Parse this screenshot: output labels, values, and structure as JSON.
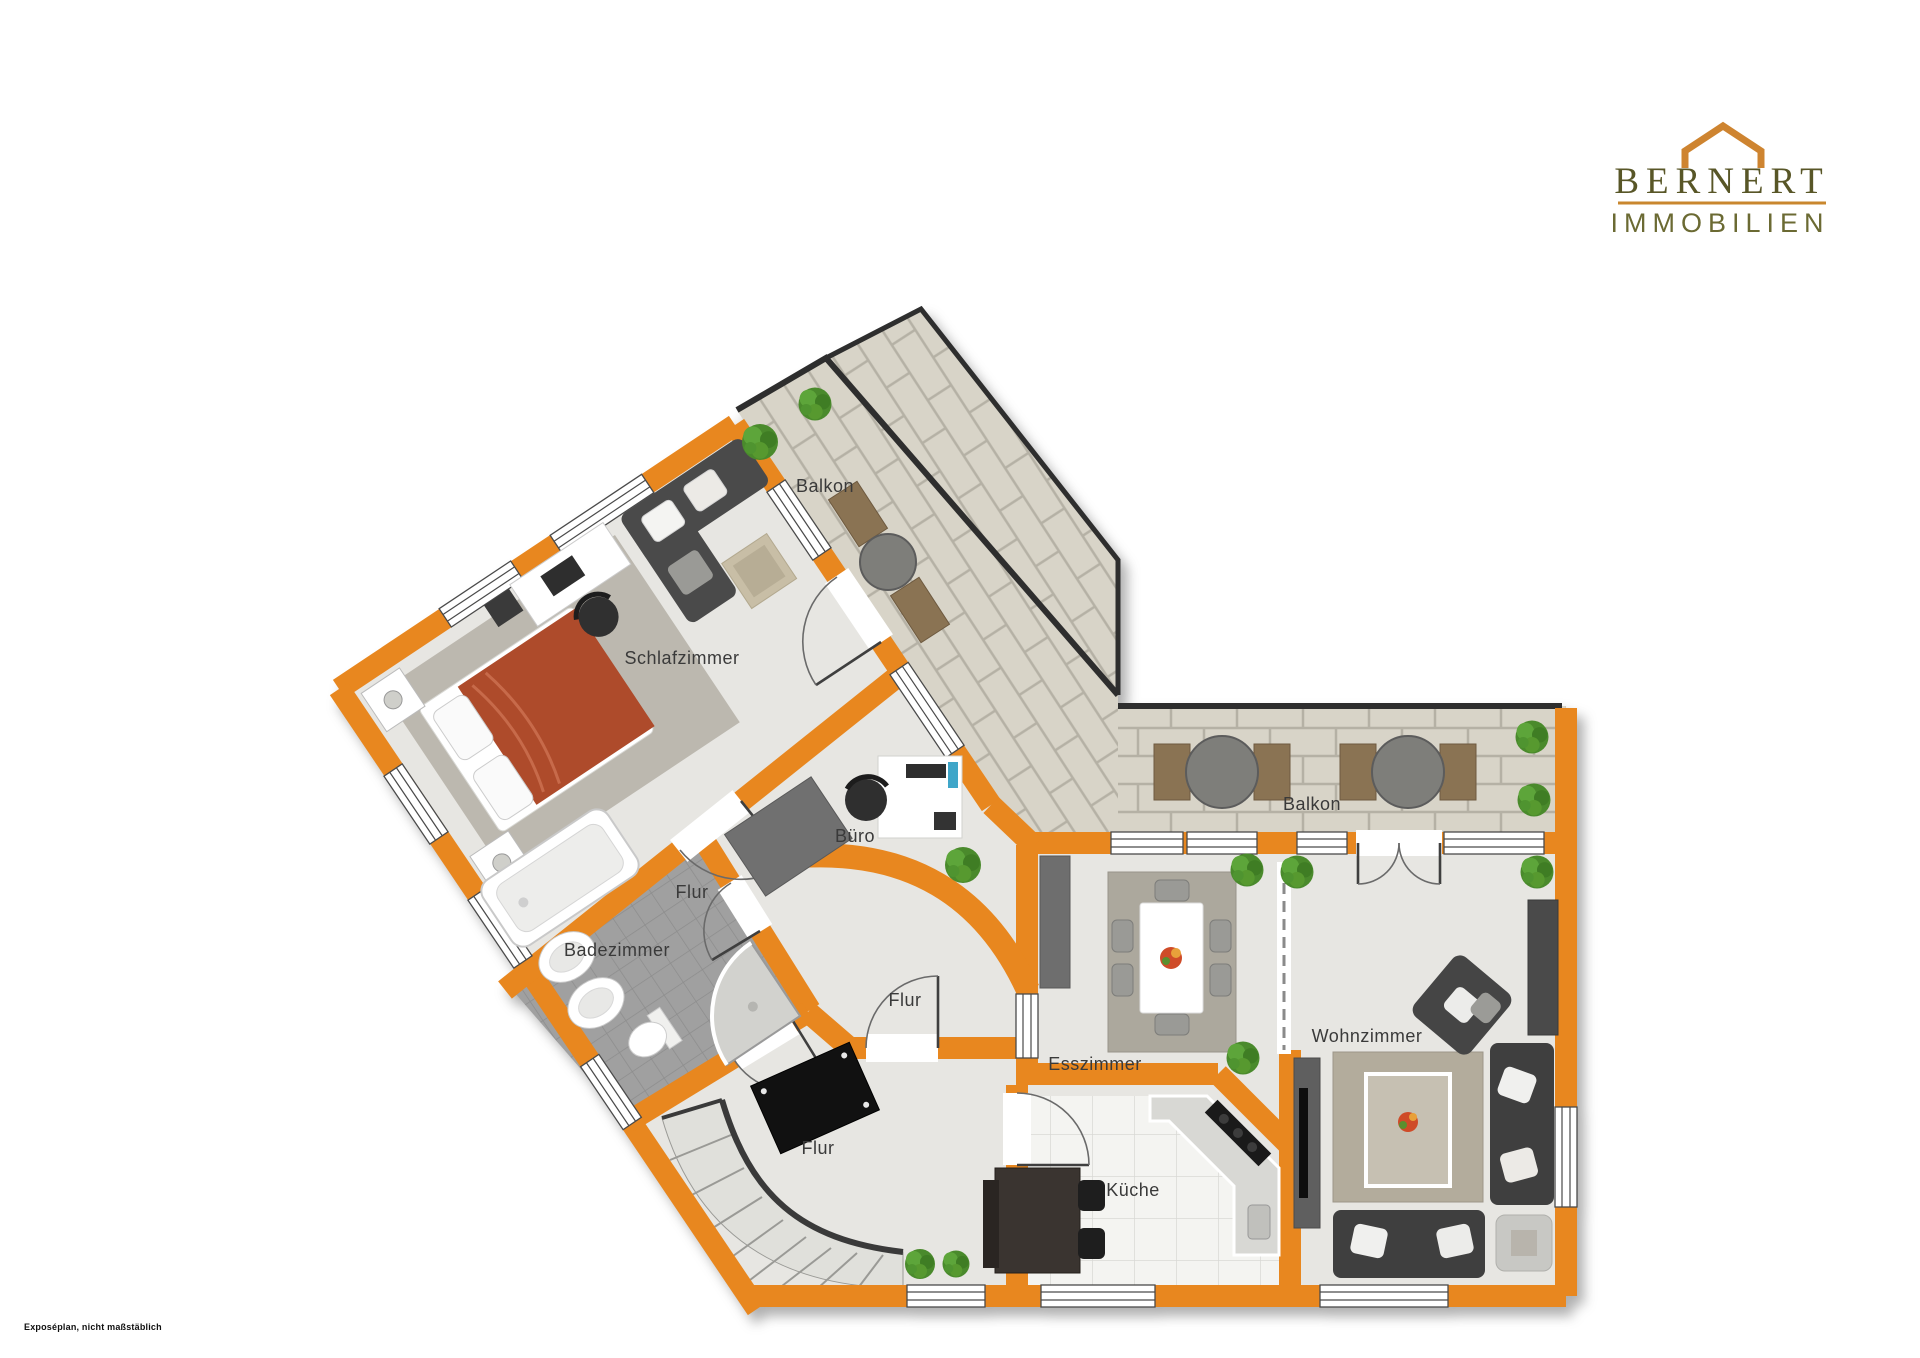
{
  "meta": {
    "disclaimer": "Exposéplan, nicht maßstäblich"
  },
  "logo": {
    "name": "BERNERT",
    "subtitle": "IMMOBILIEN",
    "roof_color": "#CE8430",
    "name_color": "#585627",
    "line_color": "#C9872E",
    "subtitle_color": "#6B6A33"
  },
  "floorplan": {
    "wall_color": "#E8871F",
    "floor_color": "#E7E6E2",
    "balcony_stone_color": "#D8D4C8",
    "bath_tile_color": "#A0A0A0",
    "kitchen_tile_color": "#F4F4F1",
    "railing_color": "#2E2E2E",
    "bed_color": "#AE4B2B",
    "rug_color": "#ACA89D",
    "furniture_dark_color": "#3F3F3F",
    "wood_color": "#8A7353",
    "rooms": [
      {
        "id": "balkon-top",
        "label": "Balkon"
      },
      {
        "id": "schlafzimmer",
        "label": "Schlafzimmer"
      },
      {
        "id": "buero",
        "label": "Büro"
      },
      {
        "id": "flur-klein",
        "label": "Flur"
      },
      {
        "id": "badezimmer",
        "label": "Badezimmer"
      },
      {
        "id": "flur-mitte",
        "label": "Flur"
      },
      {
        "id": "balkon-rechts",
        "label": "Balkon"
      },
      {
        "id": "esszimmer",
        "label": "Esszimmer"
      },
      {
        "id": "wohnzimmer",
        "label": "Wohnzimmer"
      },
      {
        "id": "flur-unten",
        "label": "Flur"
      },
      {
        "id": "kueche",
        "label": "Küche"
      }
    ]
  }
}
